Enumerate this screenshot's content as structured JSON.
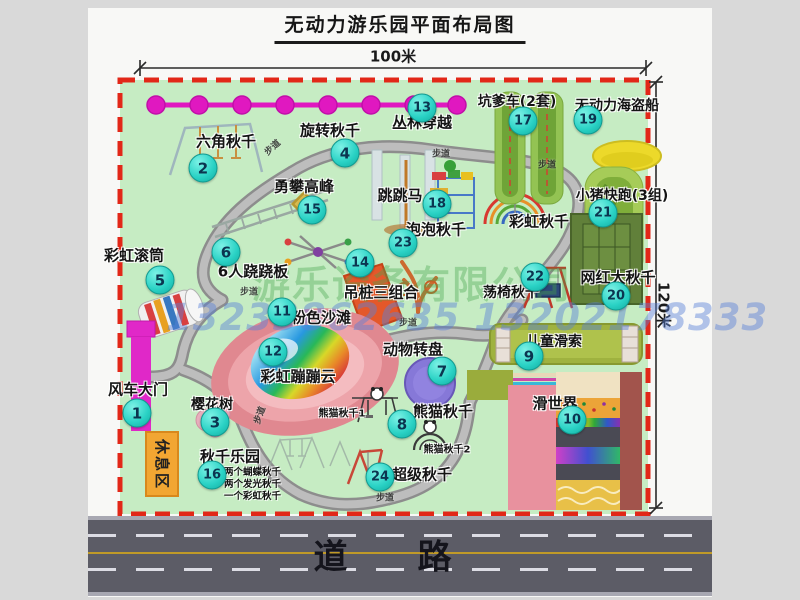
{
  "title": "无动力游乐园平面布局图",
  "dimensions": {
    "width": "100米",
    "height": "120米"
  },
  "attractions": [
    {
      "num": 1,
      "name": "风车大门"
    },
    {
      "num": 2,
      "name": "六角秋千"
    },
    {
      "num": 3,
      "name": "樱花树"
    },
    {
      "num": 4,
      "name": "旋转秋千"
    },
    {
      "num": 5,
      "name": "彩虹滚筒"
    },
    {
      "num": 6,
      "name": "6人跷跷板"
    },
    {
      "num": 7,
      "name": "动物转盘"
    },
    {
      "num": 8,
      "name": "熊猫秋千"
    },
    {
      "num": 9,
      "name": "儿童滑索"
    },
    {
      "num": 10,
      "name": "滑世界"
    },
    {
      "num": 11,
      "name": "粉色沙滩"
    },
    {
      "num": 12,
      "name": "彩虹蹦蹦云"
    },
    {
      "num": 13,
      "name": "丛林穿越"
    },
    {
      "num": 14,
      "name": "吊桩三组合"
    },
    {
      "num": 15,
      "name": "勇攀高峰"
    },
    {
      "num": 16,
      "name": "秋千乐园"
    },
    {
      "num": 17,
      "name": "坑爹车(2套)"
    },
    {
      "num": 18,
      "name": "跳跳马"
    },
    {
      "num": 19,
      "name": "无动力海盗船"
    },
    {
      "num": 20,
      "name": "网红大秋千"
    },
    {
      "num": 21,
      "name": "小猪快跑(3组)"
    },
    {
      "num": 22,
      "name": "荡椅秋千"
    },
    {
      "num": 23,
      "name": "泡泡秋千"
    },
    {
      "num": 24,
      "name": "超级秋千"
    }
  ],
  "extra_labels": [
    "彩虹秋千",
    "熊猫秋千1",
    "熊猫秋千2"
  ],
  "swing_park_items": [
    "两个蝴蝶秋千",
    "两个发光秋千",
    "一个彩虹秋千"
  ],
  "walkway_label": "步道",
  "rest_area_label": "休息区",
  "road_label": "道路",
  "watermark": {
    "company": "游乐设备有限公司",
    "phone": "13233862635 13202178333"
  },
  "colors": {
    "park_green": "#c6ecc3",
    "border_red": "#e22718",
    "badge_teal": "#2ad2c5",
    "gate_magenta": "#e028c8",
    "jungle_line_magenta": "#e018c0",
    "road_gray": "#5c5c66"
  }
}
